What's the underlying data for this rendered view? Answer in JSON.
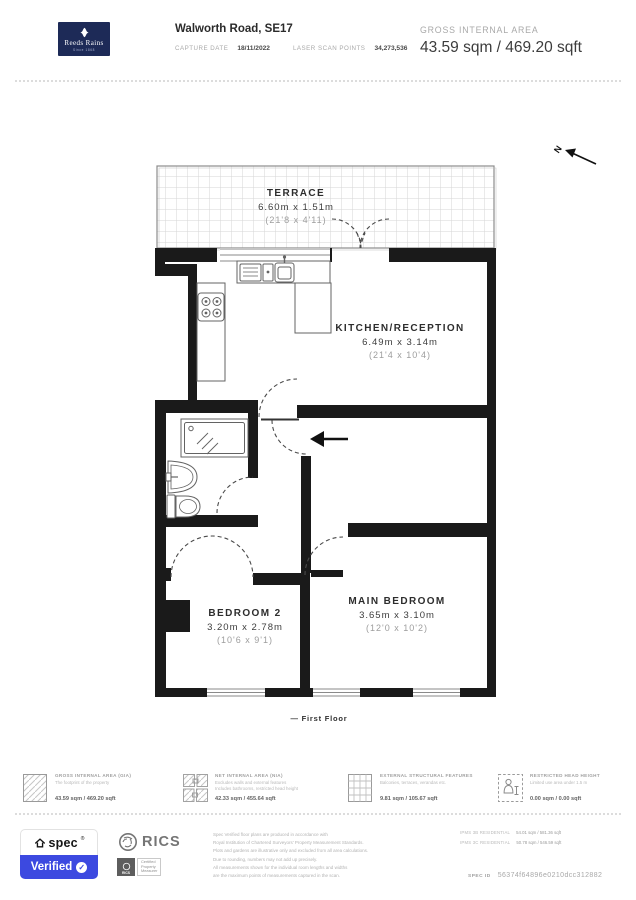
{
  "header": {
    "brand": {
      "name": "Reeds Rains",
      "since": "Since 1868"
    },
    "title": "Walworth Road, SE17",
    "meta": {
      "capture_date_label": "CAPTURE DATE",
      "capture_date": "18/11/2022",
      "laser_label": "LASER SCAN POINTS",
      "laser_points": "34,273,536"
    },
    "gia": {
      "label": "GROSS INTERNAL AREA",
      "value": "43.59 sqm / 469.20 sqft"
    }
  },
  "plan": {
    "compass": "N",
    "floor_label": "— First Floor",
    "rooms": {
      "terrace": {
        "name": "TERRACE",
        "dims_m": "6.60m x 1.51m",
        "dims_ft": "(21'8 x 4'11)"
      },
      "kitchen": {
        "name": "KITCHEN/RECEPTION",
        "dims_m": "6.49m x 3.14m",
        "dims_ft": "(21'4 x 10'4)"
      },
      "main_bedroom": {
        "name": "MAIN BEDROOM",
        "dims_m": "3.65m x 3.10m",
        "dims_ft": "(12'0 x 10'2)"
      },
      "bedroom_2": {
        "name": "BEDROOM 2",
        "dims_m": "3.20m x 2.78m",
        "dims_ft": "(10'6 x 9'1)"
      }
    }
  },
  "legend": {
    "items": [
      {
        "title": "GROSS INTERNAL AREA (GIA)",
        "desc1": "The footprint of the property",
        "desc2": "",
        "value": "43.59 sqm / 469.20 sqft",
        "icon": "hatched-square-icon"
      },
      {
        "title": "NET INTERNAL AREA (NIA)",
        "desc1": "Excludes walls and external features",
        "desc2": "Includes bathrooms, restricted head height",
        "value": "42.33 sqm / 455.64 sqft",
        "icon": "hatched-puzzle-icon"
      },
      {
        "title": "EXTERNAL STRUCTURAL FEATURES",
        "desc1": "Balconies, terraces, verandas etc.",
        "desc2": "",
        "value": "9.81 sqm / 105.67 sqft",
        "icon": "grid-square-icon"
      },
      {
        "title": "RESTRICTED HEAD HEIGHT",
        "desc1": "Limited use area under 1.5 m",
        "desc2": "",
        "value": "0.00 sqm / 0.00 sqft",
        "icon": "person-dashed-square-icon"
      }
    ]
  },
  "footer": {
    "spec_badge": {
      "brand": "spec",
      "reg": "®",
      "verified": "Verified",
      "check_glyph": "✓",
      "accent": "#3c49e0"
    },
    "rics": {
      "name": "RICS",
      "sq_label": "RICS",
      "cert_line1": "Certified",
      "cert_line2": "Property",
      "cert_line3": "Measurer"
    },
    "legal_lines": [
      "Spec Verified floor plans are produced in accordance with",
      "Royal Institution of Chartered Surveyors' Property Measurement Standards.",
      "Plots and gardens are illustrative only and excluded from all area calculations.",
      "Due to rounding, numbers may not add up precisely.",
      "All measurements shown for the individual room lengths and widths",
      "are the maximum points of measurements captured in the scan."
    ],
    "ipms": [
      {
        "label": "IPMS 3B RESIDENTIAL",
        "value": "54.01 sqm / 581.36 sqft"
      },
      {
        "label": "IPMS 3C RESIDENTIAL",
        "value": "50.78 sqm / 546.59 sqft"
      }
    ],
    "spec_id_label": "SPEC ID",
    "spec_id": "56374f64896e0210dcc312882"
  },
  "colors": {
    "navy": "#1d2a57",
    "spec_blue": "#3c49e0",
    "wall": "#1a1a1a"
  }
}
